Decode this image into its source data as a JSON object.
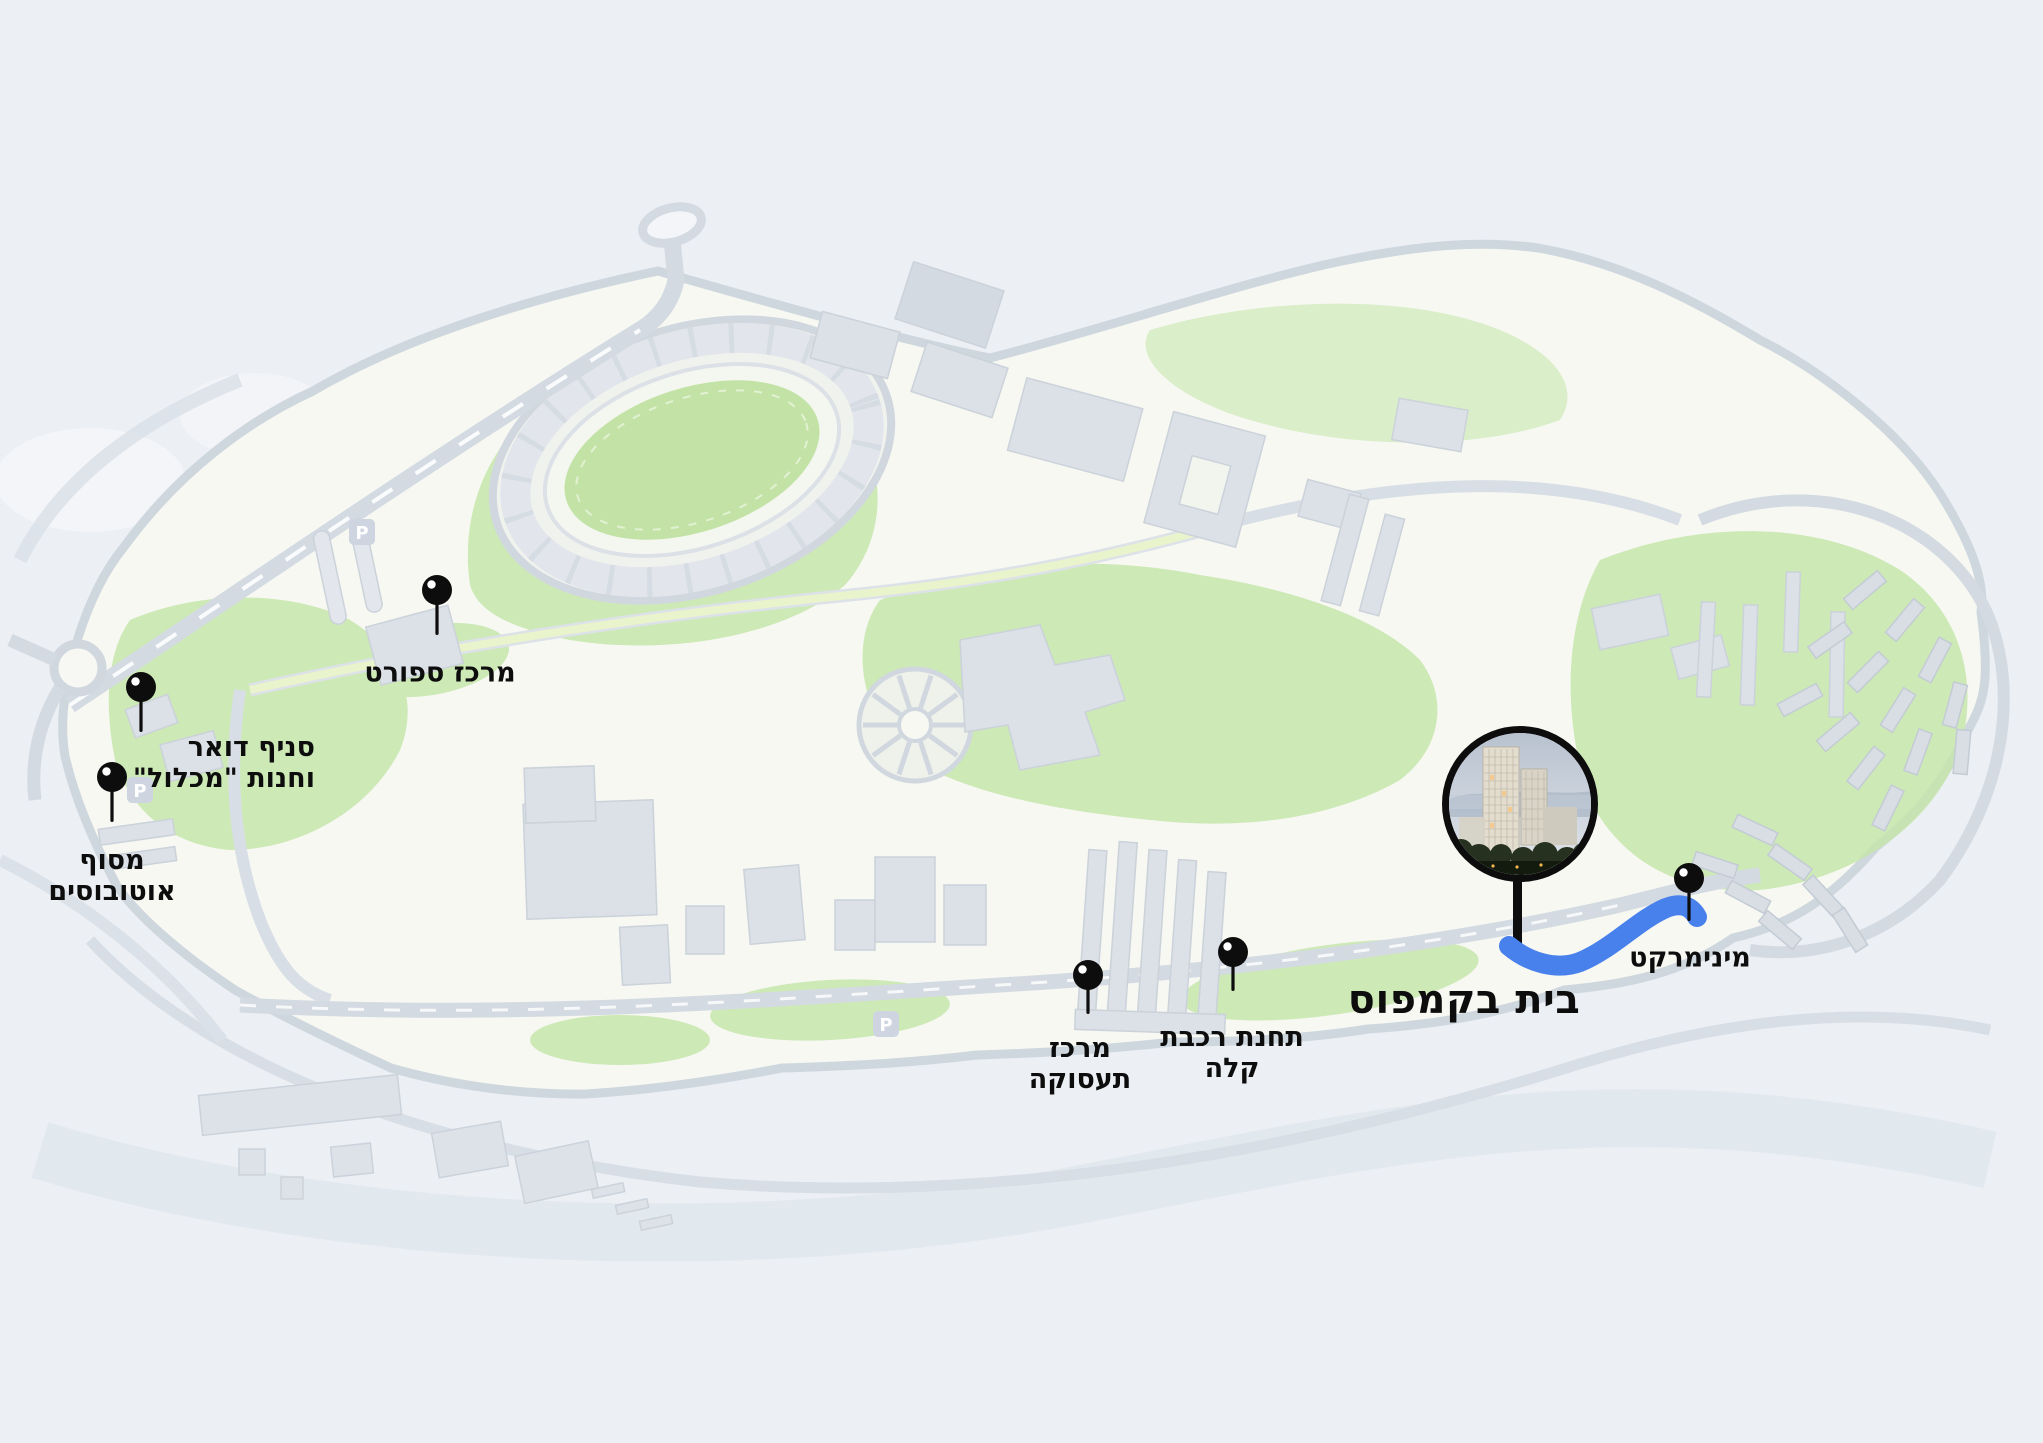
{
  "map": {
    "title": "בית בקמפוס",
    "markers": {
      "sports_center": {
        "label": "מרכז ספורט"
      },
      "post_office": {
        "line1": "סניף דואר",
        "line2": "וחנות \"מכלול\""
      },
      "bus_terminal": {
        "line1": "מסוף",
        "line2": "אוטובוסים"
      },
      "employment_center": {
        "line1": "מרכז",
        "line2": "תעסוקה"
      },
      "light_rail_station": {
        "line1": "תחנת רכבת",
        "line2": "קלה"
      },
      "minimarket": {
        "label": "מינימרקט"
      }
    },
    "badges": {
      "parking": "P"
    },
    "colors": {
      "background": "#e9edf3",
      "campus_base": "#f6f7f0",
      "green_area": "#bce29e",
      "road": "#ccd4dd",
      "building": "#d6dbe3",
      "route_blue": "#4880ec",
      "pin_black": "#0d0d0d"
    }
  }
}
